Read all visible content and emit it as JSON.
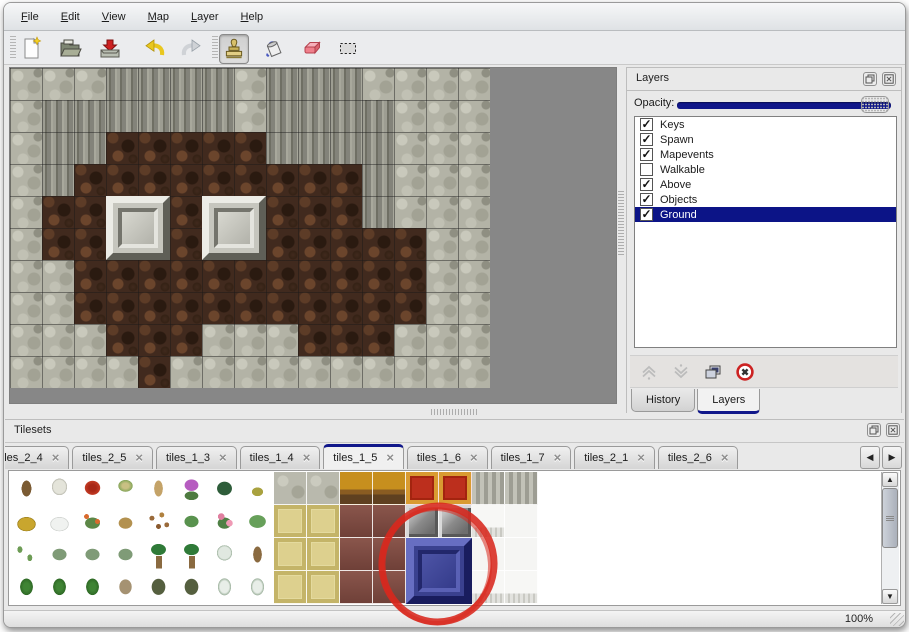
{
  "menu": {
    "items": [
      "File",
      "Edit",
      "View",
      "Map",
      "Layer",
      "Help"
    ]
  },
  "toolbar": {
    "buttons": [
      {
        "name": "new-file",
        "active": false
      },
      {
        "name": "open-file",
        "active": false
      },
      {
        "name": "save-file",
        "active": false
      },
      {
        "name": "undo",
        "active": false
      },
      {
        "name": "redo",
        "active": false
      },
      {
        "name": "stamp-tool",
        "active": true
      },
      {
        "name": "fill-tool",
        "active": false
      },
      {
        "name": "eraser-tool",
        "active": false
      },
      {
        "name": "select-tool",
        "active": false
      }
    ]
  },
  "layers_panel": {
    "title": "Layers",
    "opacity_label": "Opacity:",
    "opacity_percent": 100,
    "layers": [
      {
        "name": "Keys",
        "checked": true,
        "selected": false
      },
      {
        "name": "Spawn",
        "checked": true,
        "selected": false
      },
      {
        "name": "Mapevents",
        "checked": true,
        "selected": false
      },
      {
        "name": "Walkable",
        "checked": false,
        "selected": false
      },
      {
        "name": "Above",
        "checked": true,
        "selected": false
      },
      {
        "name": "Objects",
        "checked": true,
        "selected": false
      },
      {
        "name": "Ground",
        "checked": true,
        "selected": true
      }
    ],
    "buttons": [
      {
        "name": "move-layer-up",
        "enabled": false
      },
      {
        "name": "move-layer-down",
        "enabled": false
      },
      {
        "name": "duplicate-layer",
        "enabled": true
      },
      {
        "name": "delete-layer",
        "enabled": true
      }
    ],
    "tabs": [
      {
        "label": "History",
        "active": false
      },
      {
        "label": "Layers",
        "active": true
      }
    ]
  },
  "tilesets_panel": {
    "title": "Tilesets",
    "tabs": [
      {
        "label": "3",
        "active": false,
        "partial": true
      },
      {
        "label": "tiles_2_4",
        "active": false
      },
      {
        "label": "tiles_2_5",
        "active": false
      },
      {
        "label": "tiles_1_3",
        "active": false
      },
      {
        "label": "tiles_1_4",
        "active": false
      },
      {
        "label": "tiles_1_5",
        "active": true
      },
      {
        "label": "tiles_1_6",
        "active": false
      },
      {
        "label": "tiles_1_7",
        "active": false
      },
      {
        "label": "tiles_2_1",
        "active": false
      },
      {
        "label": "tiles_2_6",
        "active": false
      }
    ],
    "grid": [
      [
        "trunk",
        "deadtree",
        "redflower",
        "stump",
        "tantrunk",
        "purplebush",
        "fern",
        "grass",
        "cobble",
        "cobble",
        "table",
        "table",
        "carpet",
        "carpet",
        "curtain",
        "curtain"
      ],
      [
        "hay",
        "snowmound",
        "orangeflower",
        "drygrass",
        "leaves",
        "lily",
        "pinkflower",
        "lily2",
        "mat",
        "mat",
        "maroon",
        "maroon",
        "frame",
        "frame",
        "whitefringe",
        "white"
      ],
      [
        "sprouts",
        "bush",
        "bush",
        "bush",
        "palm",
        "palm",
        "snowtree",
        "palmtrunk",
        "mat",
        "mat",
        "maroon",
        "maroon",
        "blue",
        "blue",
        "white",
        "white"
      ],
      [
        "conifer",
        "conifer",
        "conifer",
        "gnarled",
        "darktree",
        "darktree",
        "snowfir",
        "snowfir",
        "mat",
        "mat",
        "maroon",
        "maroon",
        "blue",
        "blue",
        "whitefringe",
        "whitefringe"
      ]
    ],
    "selected_tile": "blue-stone-block"
  },
  "map": {
    "tile_size": 32,
    "grid": [
      "GGGCCCCGCCCGGGG",
      "GCCCCCCGCCCCGGG",
      "GCCFFFFFCCCCGGG",
      "GCFFFFFFFFFCGGG",
      "GFFFFFFFFFFCGGG",
      "GFFFFFFFFFFFFGG",
      "GGFFFFFFFFFFFGG",
      "GGFFFFFFFFFFFGG",
      "GGGFFFGGGFFFGGG",
      "GGGGFGGGGGGGGGG"
    ],
    "blocks": [
      {
        "col": 3,
        "row": 4
      },
      {
        "col": 6,
        "row": 4
      }
    ]
  },
  "status": {
    "zoom_level": "100%"
  },
  "annotation": {
    "shape": "hand-drawn-circle",
    "color": "#d8281e"
  },
  "colors": {
    "accent_navy": "#10178a",
    "selection_navy": "#0c1487",
    "eraser_pink": "#ef7f8b",
    "undo_yellow": "#e9c71f",
    "delete_red": "#cc2222"
  }
}
